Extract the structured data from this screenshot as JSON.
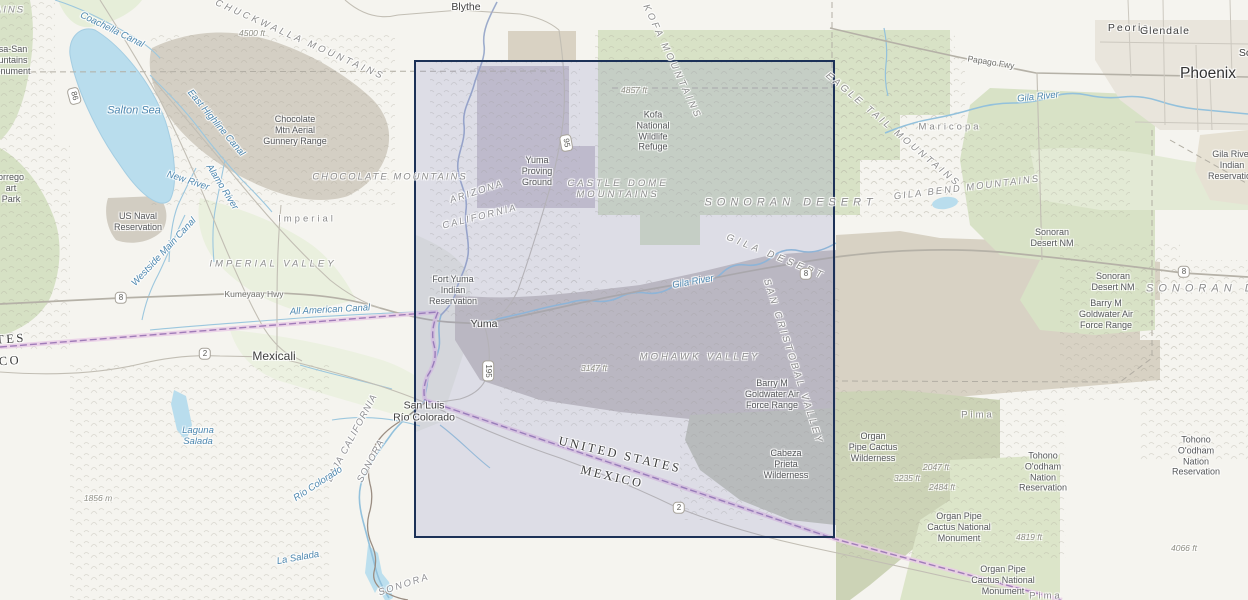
{
  "map": {
    "description": "Topographic basemap of the lower Colorado River / Yuma Arizona region with a rectangular map-extent selection",
    "selection": {
      "x": 414,
      "y": 60,
      "width": 421,
      "height": 478,
      "border_color": "#1c3157",
      "fill_color": "rgba(126,128,196,0.20)"
    },
    "colors": {
      "land": "#f5f4ef",
      "park_green": "#d7e1c5",
      "olive_green": "#ccd3b8",
      "agric_green": "#e9efdd",
      "military_gray": "#d3cec3",
      "military_mauve": "#cdc7cd",
      "military_tan": "#d8d2c4",
      "urban": "#e9e5dc",
      "water": "#b9dded",
      "river": "#93c1dc",
      "road": "#c2beb4",
      "highway": "#b7b3a9",
      "county_line": "#b2aea4",
      "intl_border": "#a07cb8",
      "intl_border_glow": "#e9cde6",
      "selection_border": "#1c3157"
    },
    "labels": [
      {
        "name": "city-blythe",
        "text": "Blythe",
        "x": 466,
        "y": 7,
        "cls": "city"
      },
      {
        "name": "city-peoria",
        "text": "Peoria",
        "x": 1129,
        "y": 28,
        "cls": "city",
        "ls": 2
      },
      {
        "name": "city-glendale",
        "text": "Glendale",
        "x": 1165,
        "y": 31,
        "cls": "city",
        "ls": 1
      },
      {
        "name": "city-phoenix",
        "text": "Phoenix",
        "x": 1208,
        "y": 74,
        "cls": "city city-lg"
      },
      {
        "name": "city-scottsdale-cut",
        "text": "Sc",
        "x": 1245,
        "y": 53,
        "cls": "city"
      },
      {
        "name": "city-mexicali",
        "text": "Mexicali",
        "x": 274,
        "y": 356,
        "cls": "city city-md"
      },
      {
        "name": "city-yuma",
        "text": "Yuma",
        "x": 484,
        "y": 324,
        "cls": "city"
      },
      {
        "name": "city-san-luis-rio-colorado",
        "lines": [
          "San Luis",
          "Río Colorado"
        ],
        "x": 424,
        "y": 412,
        "cls": "city"
      },
      {
        "name": "county-imperial",
        "text": "Imperial",
        "x": 307,
        "y": 219,
        "cls": "county"
      },
      {
        "name": "county-maricopa",
        "text": "Maricopa",
        "x": 950,
        "y": 127,
        "cls": "county"
      },
      {
        "name": "county-pima-1",
        "text": "Pima",
        "x": 978,
        "y": 415,
        "cls": "county"
      },
      {
        "name": "county-pima-2",
        "text": "Pima",
        "x": 1046,
        "y": 596,
        "cls": "county"
      },
      {
        "name": "area-chocolate-mtn-gunnery",
        "lines": [
          "Chocolate",
          "Mtn Aerial",
          "Gunnery Range"
        ],
        "x": 295,
        "y": 130,
        "cls": "area"
      },
      {
        "name": "area-us-naval-reservation",
        "lines": [
          "US Naval",
          "Reservation"
        ],
        "x": 138,
        "y": 222,
        "cls": "area"
      },
      {
        "name": "area-fort-yuma",
        "lines": [
          "Fort Yuma",
          "Indian",
          "Reservation"
        ],
        "x": 453,
        "y": 290,
        "cls": "area"
      },
      {
        "name": "area-yuma-proving-ground",
        "lines": [
          "Yuma",
          "Proving",
          "Ground"
        ],
        "x": 537,
        "y": 171,
        "cls": "area"
      },
      {
        "name": "area-kofa-nwr",
        "lines": [
          "Kofa",
          "National",
          "Wildlife",
          "Refuge"
        ],
        "x": 653,
        "y": 131,
        "cls": "area"
      },
      {
        "name": "area-goldwater-range-1",
        "lines": [
          "Barry M",
          "Goldwater Air",
          "Force Range"
        ],
        "x": 772,
        "y": 394,
        "cls": "area"
      },
      {
        "name": "area-goldwater-range-2",
        "lines": [
          "Barry M",
          "Goldwater Air",
          "Force Range"
        ],
        "x": 1106,
        "y": 314,
        "cls": "area"
      },
      {
        "name": "area-cabeza-prieta",
        "lines": [
          "Cabeza",
          "Prieta",
          "Wilderness"
        ],
        "x": 786,
        "y": 464,
        "cls": "area"
      },
      {
        "name": "area-organ-pipe-wilderness",
        "lines": [
          "Organ",
          "Pipe Cactus",
          "Wilderness"
        ],
        "x": 873,
        "y": 447,
        "cls": "area"
      },
      {
        "name": "area-organ-pipe-nm-1",
        "lines": [
          "Organ Pipe",
          "Cactus National",
          "Monument"
        ],
        "x": 959,
        "y": 527,
        "cls": "area"
      },
      {
        "name": "area-organ-pipe-nm-2",
        "lines": [
          "Organ Pipe",
          "Cactus National",
          "Monument"
        ],
        "x": 1003,
        "y": 580,
        "cls": "area"
      },
      {
        "name": "area-tohono-1",
        "lines": [
          "Tohono",
          "O'odham",
          "Nation",
          "Reservation"
        ],
        "x": 1043,
        "y": 472,
        "cls": "area"
      },
      {
        "name": "area-tohono-2",
        "lines": [
          "Tohono",
          "O'odham",
          "Nation",
          "Reservation"
        ],
        "x": 1196,
        "y": 456,
        "cls": "area"
      },
      {
        "name": "area-sonoran-desert-nm-1",
        "lines": [
          "Sonoran",
          "Desert NM"
        ],
        "x": 1052,
        "y": 238,
        "cls": "area"
      },
      {
        "name": "area-sonoran-desert-nm-2",
        "lines": [
          "Sonoran",
          "Desert NM"
        ],
        "x": 1113,
        "y": 282,
        "cls": "area"
      },
      {
        "name": "area-gila-river-reservation",
        "lines": [
          "Gila River",
          "Indian",
          "Reservation"
        ],
        "x": 1232,
        "y": 165,
        "cls": "area"
      },
      {
        "name": "area-santa-rosa-cut",
        "lines": [
          "sa-San",
          "untains",
          "onument"
        ],
        "x": 13,
        "y": 60,
        "cls": "area"
      },
      {
        "name": "area-borrego-cut",
        "lines": [
          "orrego",
          "art",
          "Park"
        ],
        "x": 11,
        "y": 188,
        "cls": "area"
      },
      {
        "name": "physio-mtns-cut",
        "text": "AINS",
        "x": 10,
        "y": 10,
        "cls": "physio",
        "ls": 2
      },
      {
        "name": "physio-chuckwalla",
        "text": "CHUCKWALLA MOUNTAINS",
        "x": 300,
        "y": 40,
        "cls": "physio",
        "rot": 24,
        "ls": 3
      },
      {
        "name": "physio-chocolate-mtns",
        "text": "CHOCOLATE MOUNTAINS",
        "x": 390,
        "y": 177,
        "cls": "physio",
        "ls": 2
      },
      {
        "name": "physio-kofa-mtns",
        "text": "KOFA MOUNTAINS",
        "x": 672,
        "y": 62,
        "cls": "physio",
        "rot": 65,
        "ls": 3
      },
      {
        "name": "physio-castle-dome",
        "lines": [
          "CASTLE DOME",
          "MOUNTAINS"
        ],
        "x": 618,
        "y": 189,
        "cls": "physio",
        "ls": 3
      },
      {
        "name": "physio-sonoran-desert",
        "text": "SONORAN DESERT",
        "x": 791,
        "y": 203,
        "cls": "physio physio-lg",
        "ls": 5
      },
      {
        "name": "physio-sonoran-desert-cut",
        "text": "SONORAN DE",
        "x": 1208,
        "y": 289,
        "cls": "physio physio-lg",
        "ls": 5
      },
      {
        "name": "physio-gila-desert",
        "text": "GILA DESERT",
        "x": 776,
        "y": 257,
        "cls": "physio",
        "rot": 22,
        "ls": 4
      },
      {
        "name": "physio-imperial-valley",
        "text": "IMPERIAL VALLEY",
        "x": 273,
        "y": 264,
        "cls": "physio",
        "ls": 3
      },
      {
        "name": "physio-mohawk-valley",
        "text": "MOHAWK VALLEY",
        "x": 700,
        "y": 357,
        "cls": "physio",
        "ls": 3
      },
      {
        "name": "physio-san-cristobal",
        "text": "SAN CRISTOBAL VALLEY",
        "x": 793,
        "y": 362,
        "cls": "physio",
        "rot": 72,
        "ls": 3
      },
      {
        "name": "physio-eagle-tail",
        "text": "EAGLE TAIL MOUNTAINS",
        "x": 893,
        "y": 130,
        "cls": "physio",
        "rot": 40,
        "ls": 3
      },
      {
        "name": "physio-gila-bend-mtns",
        "text": "GILA BEND MOUNTAINS",
        "x": 967,
        "y": 188,
        "cls": "physio",
        "rot": -7,
        "ls": 2
      },
      {
        "name": "state-arizona",
        "text": "ARIZONA",
        "x": 477,
        "y": 192,
        "cls": "physio state",
        "rot": -18,
        "ls": 2
      },
      {
        "name": "state-california",
        "text": "CALIFORNIA",
        "x": 480,
        "y": 217,
        "cls": "physio state",
        "rot": -14,
        "ls": 2
      },
      {
        "name": "state-baja-california",
        "text": "BAJA CALIFORNIA",
        "x": 352,
        "y": 438,
        "cls": "physio state",
        "rot": -62,
        "ls": 1
      },
      {
        "name": "state-sonora-1",
        "text": "SONORA",
        "x": 371,
        "y": 461,
        "cls": "physio state",
        "rot": -62,
        "ls": 1
      },
      {
        "name": "state-sonora-2",
        "text": "SONORA",
        "x": 404,
        "y": 585,
        "cls": "physio state",
        "rot": -18,
        "ls": 2
      },
      {
        "name": "border-united-states",
        "text": "UNITED STATES",
        "x": 620,
        "y": 455,
        "cls": "intl",
        "rot": 13
      },
      {
        "name": "border-mexico",
        "text": "MEXICO",
        "x": 612,
        "y": 477,
        "cls": "intl",
        "rot": 13
      },
      {
        "name": "border-united-states-cut",
        "text": "TES",
        "x": 11,
        "y": 339,
        "cls": "intl",
        "rot": -4
      },
      {
        "name": "border-mexico-cut",
        "text": "CO",
        "x": 10,
        "y": 361,
        "cls": "intl",
        "rot": -4
      },
      {
        "name": "water-salton-sea",
        "text": "Salton Sea",
        "x": 134,
        "y": 111,
        "cls": "water water-lg"
      },
      {
        "name": "water-coachella-canal",
        "text": "Coachella Canal",
        "x": 112,
        "y": 30,
        "cls": "water",
        "rot": 26
      },
      {
        "name": "water-east-highline-canal",
        "text": "East Highline Canal",
        "x": 216,
        "y": 123,
        "cls": "water",
        "rot": 50
      },
      {
        "name": "water-new-river",
        "text": "New River",
        "x": 188,
        "y": 181,
        "cls": "water",
        "rot": 18
      },
      {
        "name": "water-alamo-river",
        "text": "Alamo River",
        "x": 222,
        "y": 187,
        "cls": "water",
        "rot": 58
      },
      {
        "name": "water-westside-main-canal",
        "text": "Westside Main Canal",
        "x": 164,
        "y": 252,
        "cls": "water",
        "rot": -47
      },
      {
        "name": "water-all-american-canal",
        "text": "All American Canal",
        "x": 330,
        "y": 310,
        "cls": "water",
        "rot": -3
      },
      {
        "name": "water-laguna-salada",
        "lines": [
          "Laguna",
          "Salada"
        ],
        "x": 198,
        "y": 436,
        "cls": "water"
      },
      {
        "name": "water-rio-colorado",
        "text": "Río Colorado",
        "x": 318,
        "y": 484,
        "cls": "water",
        "rot": -33
      },
      {
        "name": "water-la-salada",
        "text": "La Salada",
        "x": 298,
        "y": 558,
        "cls": "water",
        "rot": -10
      },
      {
        "name": "water-gila-river-1",
        "text": "Gila River",
        "x": 693,
        "y": 282,
        "cls": "water",
        "rot": -10
      },
      {
        "name": "water-gila-river-2",
        "text": "Gila River",
        "x": 1038,
        "y": 97,
        "cls": "water",
        "rot": -6
      },
      {
        "name": "elev-4500ft",
        "text": "4500 ft",
        "x": 252,
        "y": 33,
        "cls": "elev"
      },
      {
        "name": "elev-4857ft",
        "text": "4857 ft",
        "x": 634,
        "y": 90,
        "cls": "elev"
      },
      {
        "name": "elev-3147ft",
        "text": "3147 ft",
        "x": 594,
        "y": 368,
        "cls": "elev"
      },
      {
        "name": "elev-1856m",
        "text": "1856 m",
        "x": 98,
        "y": 498,
        "cls": "elev"
      },
      {
        "name": "elev-2047ft",
        "text": "2047 ft",
        "x": 936,
        "y": 467,
        "cls": "elev"
      },
      {
        "name": "elev-3235ft",
        "text": "3235 ft",
        "x": 907,
        "y": 478,
        "cls": "elev"
      },
      {
        "name": "elev-2484ft",
        "text": "2484 ft",
        "x": 942,
        "y": 487,
        "cls": "elev"
      },
      {
        "name": "elev-4819ft",
        "text": "4819 ft",
        "x": 1029,
        "y": 537,
        "cls": "elev"
      },
      {
        "name": "elev-4066ft",
        "text": "4066 ft",
        "x": 1184,
        "y": 548,
        "cls": "elev"
      },
      {
        "name": "road-label-kumeyaay-hwy",
        "text": "Kumeyaay Hwy",
        "x": 254,
        "y": 294,
        "cls": "roadlbl"
      },
      {
        "name": "road-label-papago-fwy",
        "text": "Papago Fwy",
        "x": 991,
        "y": 62,
        "cls": "roadlbl",
        "rot": 9
      },
      {
        "name": "route-shield-86",
        "text": "86",
        "x": 74,
        "y": 96,
        "cls": "shield",
        "rot": 75
      },
      {
        "name": "route-shield-8-west",
        "text": "8",
        "x": 121,
        "y": 298,
        "cls": "shield"
      },
      {
        "name": "route-shield-2-mexicali",
        "text": "2",
        "x": 205,
        "y": 354,
        "cls": "shield"
      },
      {
        "name": "route-shield-195",
        "text": "195",
        "x": 488,
        "y": 371,
        "cls": "shield",
        "rot": 90
      },
      {
        "name": "route-shield-95",
        "text": "95",
        "x": 566,
        "y": 143,
        "cls": "shield",
        "rot": 80
      },
      {
        "name": "route-shield-8-gila",
        "text": "8",
        "x": 806,
        "y": 274,
        "cls": "shield"
      },
      {
        "name": "route-shield-8-east",
        "text": "8",
        "x": 1184,
        "y": 272,
        "cls": "shield"
      },
      {
        "name": "route-shield-2-border",
        "text": "2",
        "x": 679,
        "y": 508,
        "cls": "shield"
      }
    ]
  }
}
